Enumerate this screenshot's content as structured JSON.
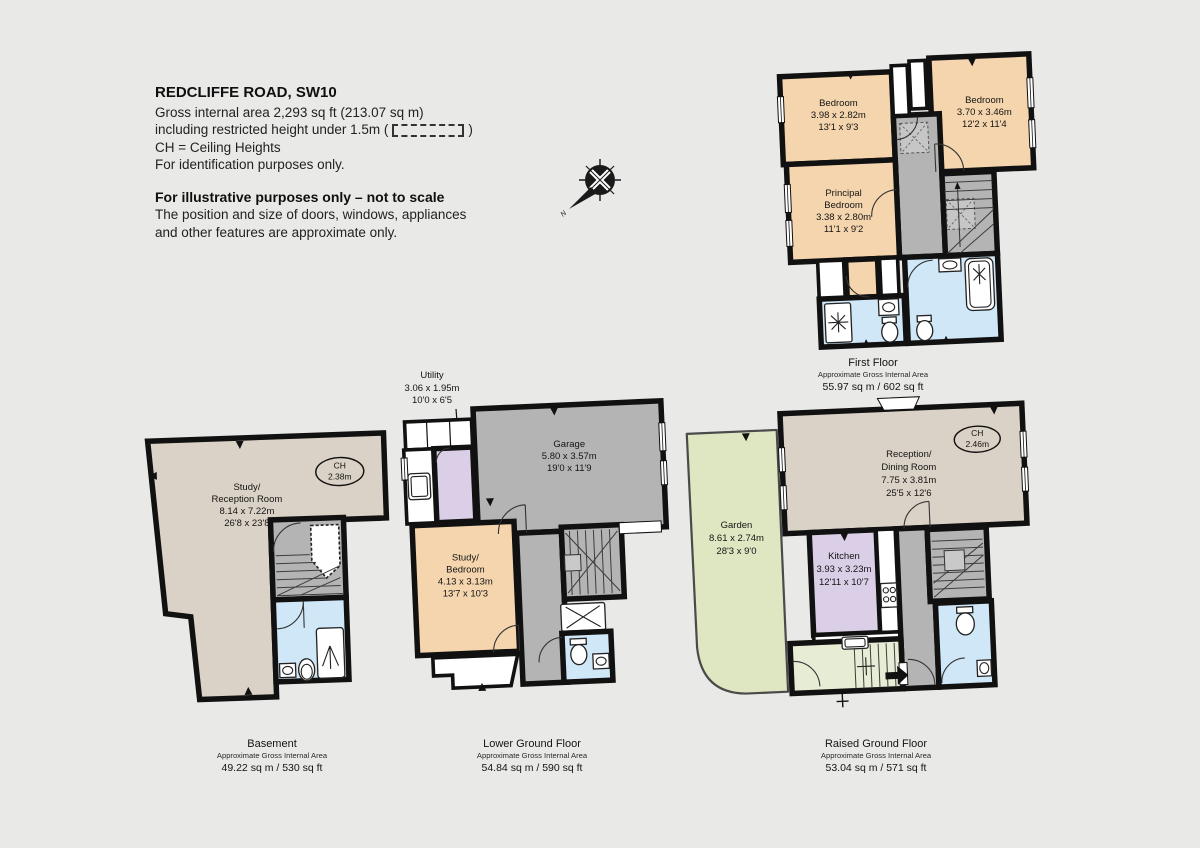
{
  "header": {
    "title": "REDCLIFFE ROAD, SW10",
    "line1": "Gross internal area 2,293 sq ft (213.07 sq m)",
    "line2_pre": "including restricted height under 1.5m (",
    "line2_post": ")",
    "line3": "CH =  Ceiling Heights",
    "line4": "For identification purposes only.",
    "notice_title": "For illustrative purposes only – not to scale",
    "notice_line1": "The position and size of doors, windows, appliances",
    "notice_line2": "and other features are approximate only."
  },
  "compass": {
    "north": "N"
  },
  "colors": {
    "background": "#e9e9e7",
    "wall": "#111111",
    "room_peach": "#f4d5ae",
    "room_gray": "#b4b4b4",
    "room_blue": "#cfe7f7",
    "room_beige": "#dad2c6",
    "room_green": "#dfe7c2",
    "room_green_light": "#e7ecd4",
    "room_lavender": "#dbcfe8",
    "restricted_fill": "#c6c6c6",
    "white": "#ffffff"
  },
  "floors": {
    "first": {
      "name": "First Floor",
      "area_note": "Approximate Gross Internal Area",
      "area": "55.97 sq m  /  602 sq ft",
      "rooms": {
        "bedroom_left": {
          "name": "Bedroom",
          "metric": "3.98 x 2.82m",
          "imperial": "13'1 x 9'3"
        },
        "bedroom_right": {
          "name": "Bedroom",
          "metric": "3.70 x 3.46m",
          "imperial": "12'2 x 11'4"
        },
        "principal": {
          "name1": "Principal",
          "name2": "Bedroom",
          "metric": "3.38 x 2.80m",
          "imperial": "11'1 x 9'2"
        }
      }
    },
    "basement": {
      "name": "Basement",
      "area_note": "Approximate Gross Internal Area",
      "area": "49.22 sq m  /  530 sq ft",
      "ch": {
        "label": "CH",
        "value": "2.38m"
      },
      "rooms": {
        "study": {
          "name1": "Study/",
          "name2": "Reception Room",
          "metric": "8.14 x 7.22m",
          "imperial": "26'8 x 23'8"
        }
      }
    },
    "lower": {
      "name": "Lower Ground Floor",
      "area_note": "Approximate Gross Internal Area",
      "area": "54.84 sq m  /  590 sq ft",
      "rooms": {
        "utility": {
          "name": "Utility",
          "metric": "3.06 x 1.95m",
          "imperial": "10'0 x 6'5"
        },
        "garage": {
          "name": "Garage",
          "metric": "5.80 x 3.57m",
          "imperial": "19'0 x 11'9"
        },
        "study_bedroom": {
          "name1": "Study/",
          "name2": "Bedroom",
          "metric": "4.13 x 3.13m",
          "imperial": "13'7 x 10'3"
        }
      }
    },
    "raised": {
      "name": "Raised Ground Floor",
      "area_note": "Approximate Gross Internal Area",
      "area": "53.04 sq m  /  571 sq ft",
      "ch": {
        "label": "CH",
        "value": "2.46m"
      },
      "rooms": {
        "garden": {
          "name": "Garden",
          "metric": "8.61 x 2.74m",
          "imperial": "28'3 x 9'0"
        },
        "reception": {
          "name1": "Reception/",
          "name2": "Dining Room",
          "metric": "7.75 x 3.81m",
          "imperial": "25'5 x 12'6"
        },
        "kitchen": {
          "name": "Kitchen",
          "metric": "3.93 x 3.23m",
          "imperial": "12'11 x 10'7"
        }
      }
    }
  }
}
